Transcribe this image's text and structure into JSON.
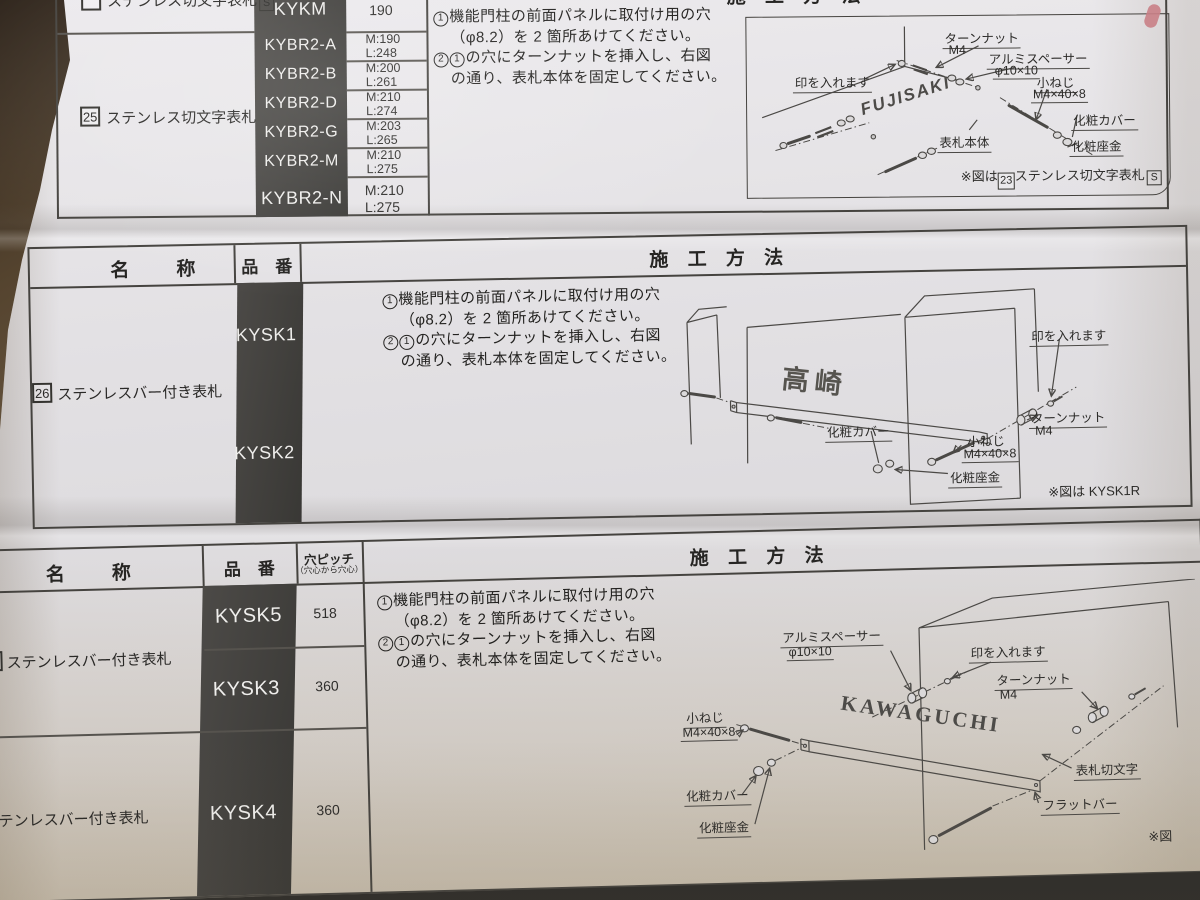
{
  "method_header": "施 工 方 法",
  "headers": {
    "name": "名　称",
    "code": "品　番",
    "pitch": "穴ピッチ",
    "pitch_sub": "（穴心から穴心）"
  },
  "instructions": {
    "s1n": "1",
    "s1a": "機能門柱の前面パネルに取付け用の穴",
    "s1b": "（φ8.2）を 2 箇所あけてください。",
    "s2n": "2",
    "s2n2": "1",
    "s2a": "の穴にターンナットを挿入し、右図",
    "s2b": "の通り、表札本体を固定してください。"
  },
  "parts": {
    "turnnut": "ターンナット",
    "m4": "M4",
    "spacer": "アルミスペーサー",
    "spacer_size": "φ10×10",
    "mark": "印を入れます",
    "screw": "小ねじ",
    "screw_size": "M4×40×8",
    "cover": "化粧カバー",
    "washer": "化粧座金",
    "body": "表札本体",
    "cut_letters": "表札切文字",
    "flat_bar": "フラットバー"
  },
  "section1": {
    "top_row": {
      "name": "ステンレス切文字表札",
      "badge": "S",
      "code": "KYKM",
      "size": "190"
    },
    "group": {
      "num": "25",
      "name": "ステンレス切文字表札"
    },
    "models": [
      {
        "code": "KYBR2-A",
        "size_m": "M:190",
        "size_l": "L:248"
      },
      {
        "code": "KYBR2-B",
        "size_m": "M:200",
        "size_l": "L:261"
      },
      {
        "code": "KYBR2-D",
        "size_m": "M:210",
        "size_l": "L:274"
      },
      {
        "code": "KYBR2-G",
        "size_m": "M:203",
        "size_l": "L:265"
      },
      {
        "code": "KYBR2-M",
        "size_m": "M:210",
        "size_l": "L:275"
      },
      {
        "code": "KYBR2-N",
        "size_m": "M:210",
        "size_l": "L:275"
      }
    ],
    "plate": "FUJISAKI",
    "note": {
      "prefix": "※図は",
      "num": "23",
      "name": "ステンレス切文字表札",
      "badge": "S"
    }
  },
  "section2": {
    "group": {
      "num": "26",
      "name": "ステンレスバー付き表札"
    },
    "code1": "KYSK1",
    "code2": "KYSK2",
    "plate": "高崎",
    "note": "※図は KYSK1R"
  },
  "section3": {
    "group1": "ステンレスバー付き表札",
    "group2": "テンレスバー付き表札",
    "row1": {
      "code": "KYSK5",
      "pitch": "518"
    },
    "row2": {
      "code": "KYSK3",
      "pitch": "360"
    },
    "row3": {
      "code": "KYSK4",
      "pitch": "360"
    },
    "plate": "KAWAGUCHI",
    "note": "※図"
  }
}
